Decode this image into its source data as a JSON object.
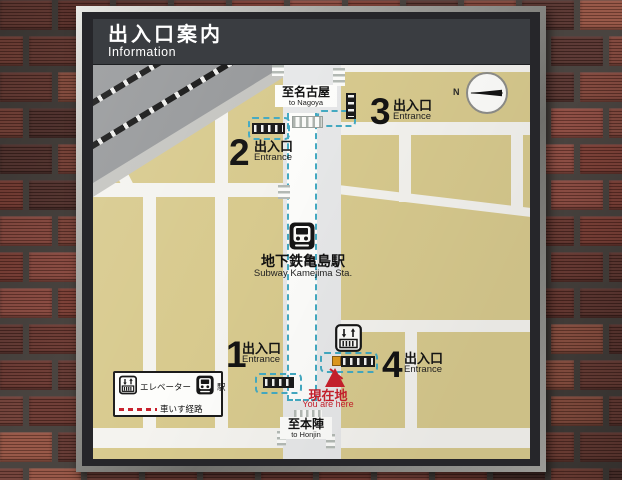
{
  "sign": {
    "header": {
      "title_jp": "出入口案内",
      "title_en": "Information"
    },
    "map": {
      "destination_top": {
        "jp": "至名古屋",
        "en": "to Nagoya"
      },
      "destination_bottom": {
        "jp": "至本陣",
        "en": "to Honjin"
      },
      "station": {
        "jp": "地下鉄亀島駅",
        "en": "Subway Kamejima Sta."
      },
      "entrances": [
        {
          "number": "1",
          "label_jp": "出入口",
          "label_en": "Entrance"
        },
        {
          "number": "2",
          "label_jp": "出入口",
          "label_en": "Entrance"
        },
        {
          "number": "3",
          "label_jp": "出入口",
          "label_en": "Entrance"
        },
        {
          "number": "4",
          "label_jp": "出入口",
          "label_en": "Entrance"
        }
      ],
      "you_are_here": {
        "jp": "現在地",
        "en": "You are here"
      },
      "compass": {
        "label": "N"
      }
    },
    "legend": {
      "elevator": "エレベーター",
      "station": "駅",
      "wheelchair_route": "車いす経路"
    }
  },
  "colors": {
    "brick_mortar": "#4a4440",
    "frame_silver": "#b9b9b5",
    "header_bg": "#3a3d41",
    "map_bg": "#f3f2ee",
    "block_beige": "#d8ca8e",
    "road_gray": "#e7e8e9",
    "rail_band_gray": "#97999b",
    "corridor_dash_teal": "#44aac2",
    "alert_red": "#c8202c",
    "elevator_orange": "#e09a1e",
    "brick_palette": [
      "#6e3b33",
      "#7d4136",
      "#8a473c",
      "#5f332c",
      "#93503f",
      "#54302b",
      "#7a3a30",
      "#68352d"
    ]
  }
}
